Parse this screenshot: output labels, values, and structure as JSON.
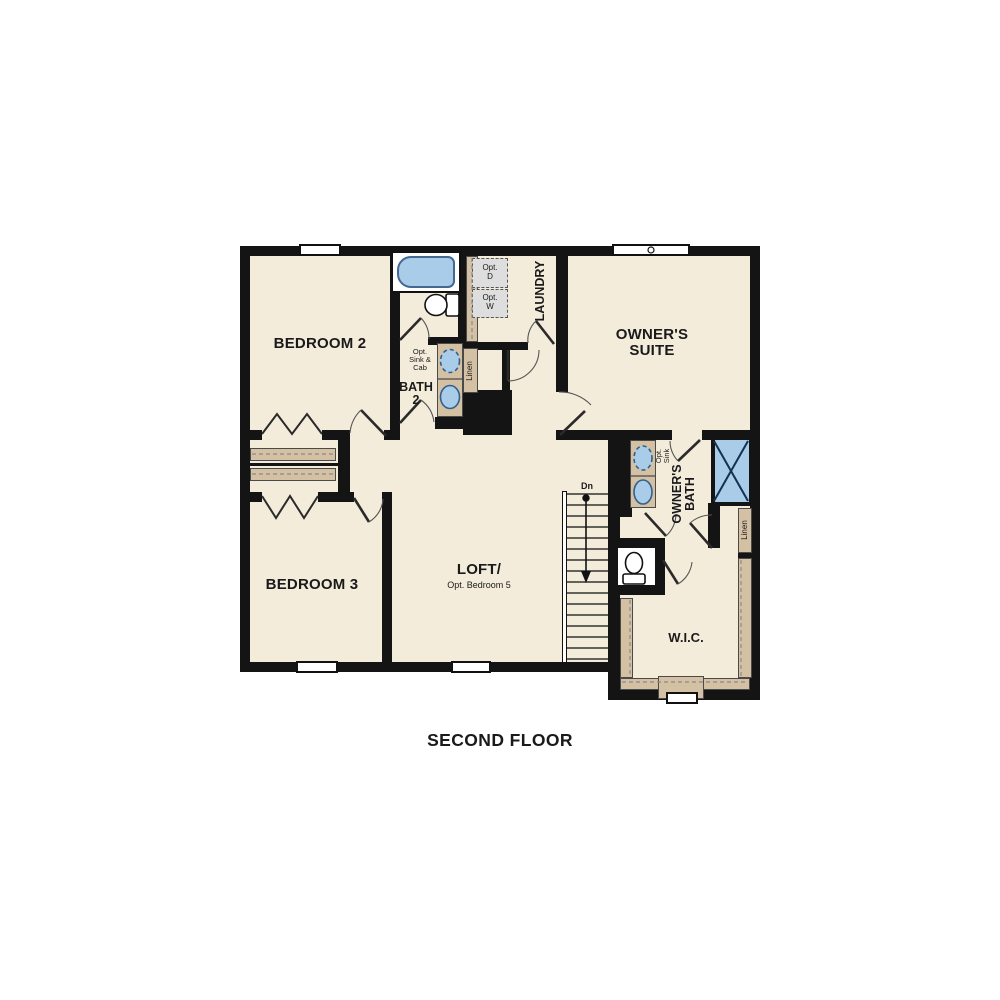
{
  "title": "SECOND FLOOR",
  "rooms": {
    "bedroom2": {
      "label": "BEDROOM 2"
    },
    "bedroom3": {
      "label": "BEDROOM 3"
    },
    "owners_suite": {
      "label": "OWNER'S SUITE"
    },
    "owners_bath": {
      "label": "OWNER'S BATH"
    },
    "bath2": {
      "label": "BATH 2"
    },
    "laundry": {
      "label": "LAUNDRY"
    },
    "loft": {
      "label": "LOFT/",
      "sublabel": "Opt. Bedroom 5"
    },
    "wic": {
      "label": "W.I.C."
    }
  },
  "annotations": {
    "opt_sink_cab": "Opt. Sink & Cab",
    "opt_sink": "Opt. Sink",
    "linen_bath2": "Linen",
    "linen_owners": "Linen",
    "opt_dryer": "Opt. D",
    "opt_washer": "Opt. W",
    "stairs_down": "Dn"
  },
  "colors": {
    "floor": "#f4ecdb",
    "wall": "#141414",
    "cabinet_tan": "#d4c1a4",
    "fixture_blue": "#a9cde9",
    "optional_gray": "#dedede"
  }
}
